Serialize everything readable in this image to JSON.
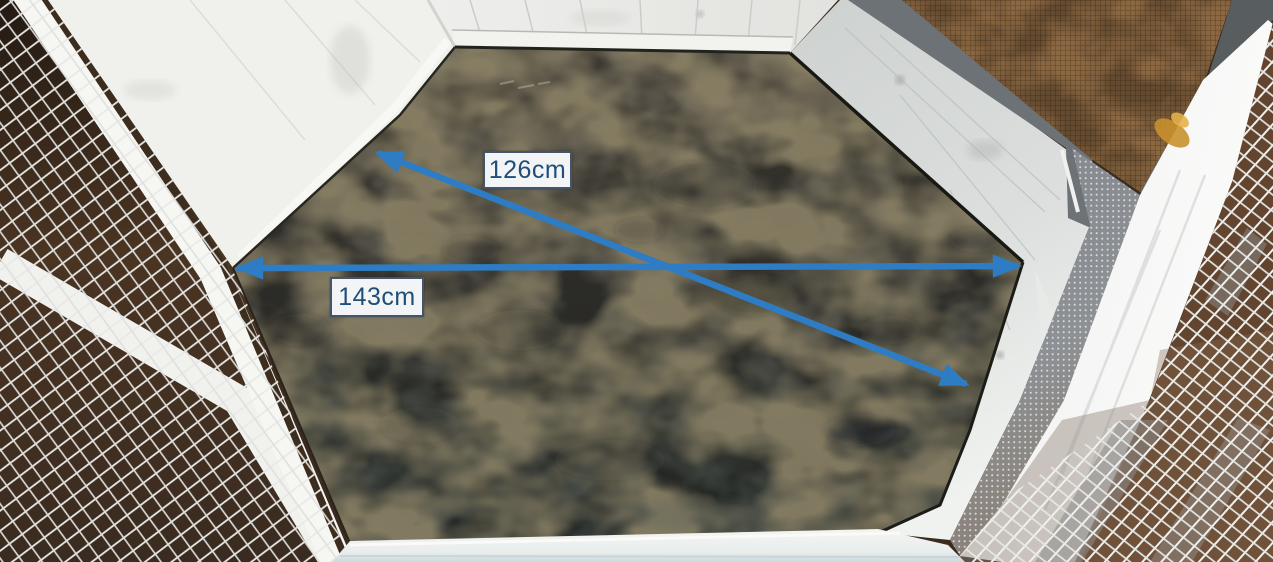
{
  "measurements": {
    "diagonal": {
      "label": "126cm"
    },
    "width": {
      "label": "143cm"
    }
  },
  "colors": {
    "arrow": "#2e7cc4",
    "label_background": "#f2f4f5",
    "label_border": "#44546a",
    "label_text": "#1f4e79",
    "floor_concrete": "#4c4b44",
    "wall_wood_white": "#e9e9e6",
    "wall_wood_gray": "#d2d6d4",
    "mesh_wire": "#eceeec",
    "mesh_backdrop_left": "#3a2b1e",
    "mesh_backdrop_right": "#6b4a33",
    "mesh_door_brown": "#8c6842",
    "frame_dark_gray": "#6d7276"
  }
}
